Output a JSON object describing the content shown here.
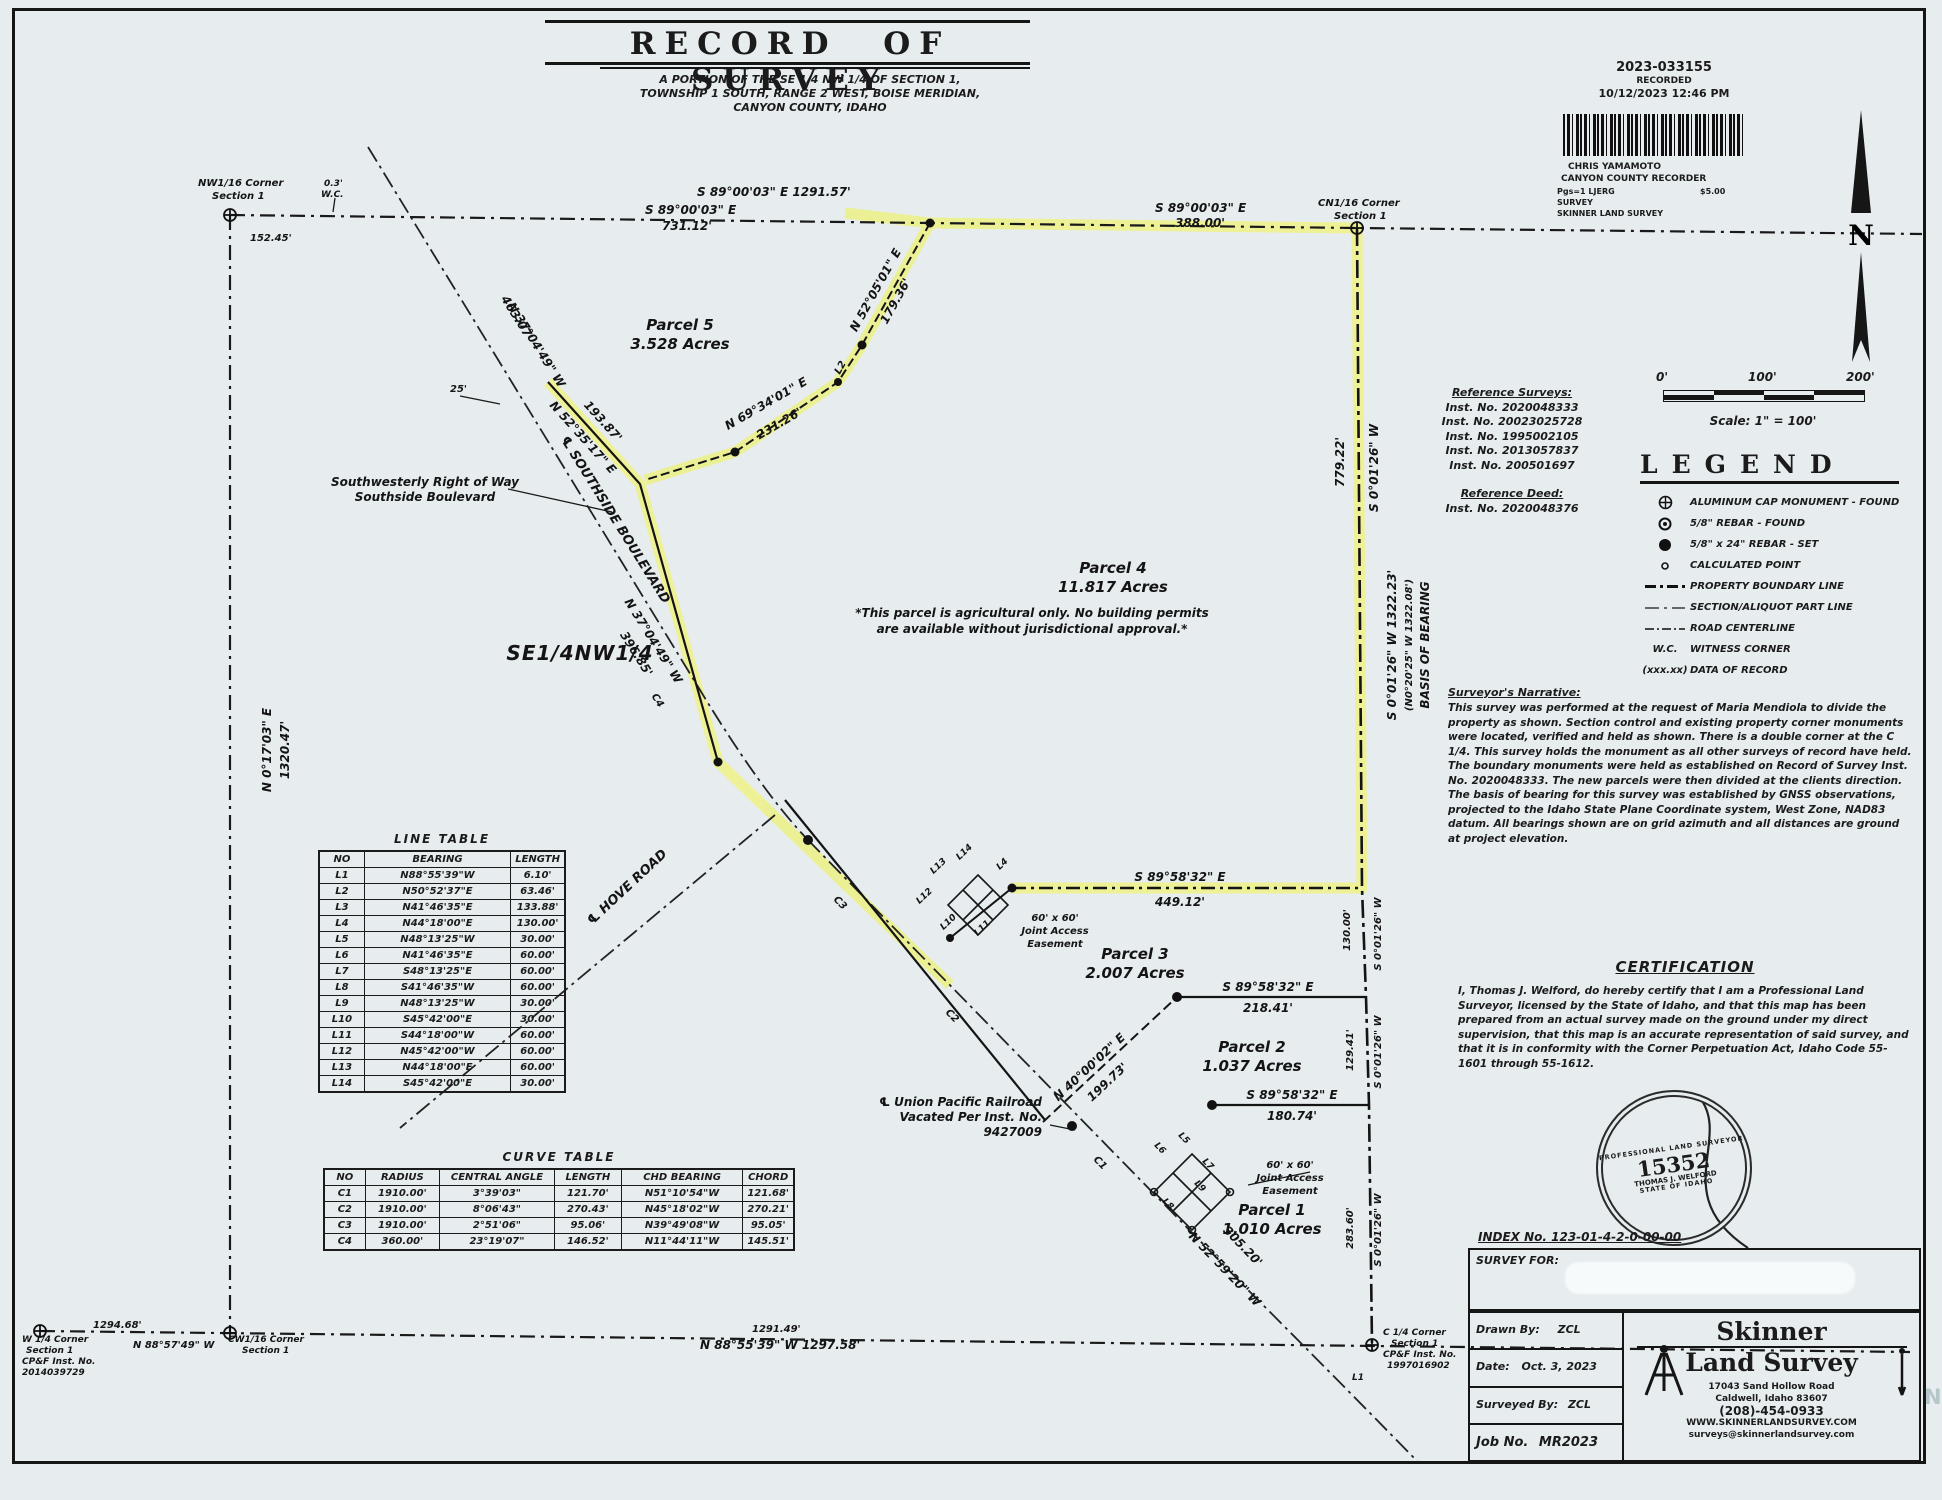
{
  "title": {
    "main": "RECORD OF SURVEY",
    "sub1": "A PORTION OF THE SE 1/4 NW 1/4 OF SECTION 1,",
    "sub2": "TOWNSHIP 1 SOUTH, RANGE 2 WEST, BOISE MERIDIAN,",
    "sub3": "CANYON COUNTY, IDAHO"
  },
  "recording": {
    "number": "2023-033155",
    "recorded": "RECORDED",
    "datetime": "10/12/2023 12:46 PM",
    "recorder_name": "CHRIS YAMAMOTO",
    "recorder_title": "CANYON COUNTY RECORDER",
    "pgs": "Pgs=1 LJERG",
    "fee": "$5.00",
    "doc_type": "SURVEY",
    "requestor": "SKINNER LAND SURVEY"
  },
  "north_label": "N",
  "scale": {
    "t0": "0'",
    "t1": "100'",
    "t2": "200'",
    "caption": "Scale: 1\" = 100'"
  },
  "legend": {
    "title": "LEGEND",
    "wc_sym": "W.C.",
    "dor_sym": "(xxx.xx)",
    "items": [
      {
        "icon": "aluminum-cap",
        "label": "ALUMINUM CAP MONUMENT - FOUND"
      },
      {
        "icon": "rebar-found",
        "label": "5/8\" REBAR - FOUND"
      },
      {
        "icon": "rebar-set",
        "label": "5/8\" x 24\" REBAR - SET"
      },
      {
        "icon": "calculated-point",
        "label": "CALCULATED POINT"
      },
      {
        "icon": "property-boundary-line",
        "label": "PROPERTY BOUNDARY LINE"
      },
      {
        "icon": "section-aliquot-line",
        "label": "SECTION/ALIQUOT PART LINE"
      },
      {
        "icon": "road-centerline",
        "label": "ROAD CENTERLINE"
      },
      {
        "icon": "witness-corner",
        "label": "WITNESS CORNER"
      },
      {
        "icon": "data-of-record",
        "label": "DATA OF RECORD"
      }
    ]
  },
  "references": {
    "surveys_title": "Reference Surveys:",
    "surveys": [
      "Inst. No. 2020048333",
      "Inst. No. 20023025728",
      "Inst. No. 1995002105",
      "Inst. No. 2013057837",
      "Inst. No. 200501697"
    ],
    "deed_title": "Reference Deed:",
    "deed": "Inst. No. 2020048376"
  },
  "narrative": {
    "title": "Surveyor's Narrative:",
    "body": "This survey was performed at the request of Maria Mendiola to divide the property as shown. Section control and existing property corner monuments were located, verified and held as shown. There is a double corner at the C 1/4. This survey holds the monument as all other surveys of record have held. The boundary monuments were held as established on Record of Survey Inst. No. 2020048333. The new parcels were then divided at the clients direction. The basis of bearing for this survey was established by GNSS observations, projected to the Idaho State Plane Coordinate system, West Zone, NAD83 datum. All bearings shown are on grid azimuth and all distances are ground at project elevation."
  },
  "certification": {
    "title": "CERTIFICATION",
    "body": "I, Thomas J. Welford, do hereby certify that I am a Professional Land Surveyor, licensed by the State of Idaho, and that this map has been prepared from an actual survey made on the ground under my direct supervision, that this map is an accurate representation of said survey, and that it is in conformity with the Corner Perpetuation Act, Idaho Code 55-1601 through 55-1612.",
    "seal_line1": "PROFESSIONAL LAND SURVEYOR",
    "seal_number": "15352",
    "seal_name": "THOMAS J. WELFORD",
    "seal_line2": "STATE OF IDAHO"
  },
  "index_label": "INDEX No. 123-01-4-2-0-00-00",
  "titleblock": {
    "survey_for_label": "SURVEY FOR:",
    "drawn_by_label": "Drawn By:",
    "drawn_by": "ZCL",
    "date_label": "Date:",
    "date": "Oct. 3, 2023",
    "surveyed_by_label": "Surveyed By:",
    "surveyed_by": "ZCL",
    "job_label": "Job No.",
    "job": "MR2023",
    "firm1": "Skinner",
    "firm2": "Land Survey",
    "addr1": "17043 Sand Hollow Road",
    "addr2": "Caldwell, Idaho 83607",
    "phone": "(208)-454-0933",
    "web": "WWW.SKINNERLANDSURVEY.COM",
    "email": "surveys@skinnerlandsurvey.com"
  },
  "watermark": "NTAIN",
  "line_table": {
    "title": "LINE TABLE",
    "headers": [
      "NO",
      "BEARING",
      "LENGTH"
    ],
    "rows": [
      [
        "L1",
        "N88°55'39\"W",
        "6.10'"
      ],
      [
        "L2",
        "N50°52'37\"E",
        "63.46'"
      ],
      [
        "L3",
        "N41°46'35\"E",
        "133.88'"
      ],
      [
        "L4",
        "N44°18'00\"E",
        "130.00'"
      ],
      [
        "L5",
        "N48°13'25\"W",
        "30.00'"
      ],
      [
        "L6",
        "N41°46'35\"E",
        "60.00'"
      ],
      [
        "L7",
        "S48°13'25\"E",
        "60.00'"
      ],
      [
        "L8",
        "S41°46'35\"W",
        "60.00'"
      ],
      [
        "L9",
        "N48°13'25\"W",
        "30.00'"
      ],
      [
        "L10",
        "S45°42'00\"E",
        "30.00'"
      ],
      [
        "L11",
        "S44°18'00\"W",
        "60.00'"
      ],
      [
        "L12",
        "N45°42'00\"W",
        "60.00'"
      ],
      [
        "L13",
        "N44°18'00\"E",
        "60.00'"
      ],
      [
        "L14",
        "S45°42'00\"E",
        "30.00'"
      ]
    ]
  },
  "curve_table": {
    "title": "CURVE TABLE",
    "headers": [
      "NO",
      "RADIUS",
      "CENTRAL ANGLE",
      "LENGTH",
      "CHD BEARING",
      "CHORD"
    ],
    "rows": [
      [
        "C1",
        "1910.00'",
        "3°39'03\"",
        "121.70'",
        "N51°10'54\"W",
        "121.68'"
      ],
      [
        "C2",
        "1910.00'",
        "8°06'43\"",
        "270.43'",
        "N45°18'02\"W",
        "270.21'"
      ],
      [
        "C3",
        "1910.00'",
        "2°51'06\"",
        "95.06'",
        "N39°49'08\"W",
        "95.05'"
      ],
      [
        "C4",
        "360.00'",
        "23°19'07\"",
        "146.52'",
        "N11°44'11\"W",
        "145.51'"
      ]
    ]
  },
  "map": {
    "nw1": "NW1/16 Corner",
    "sec1": "Section 1",
    "d152": "152.45'",
    "wc_d": "0.3'",
    "wc": "W.C.",
    "topmain": "S 89°00'03\" E    1291.57'",
    "b8900": "S 89°00'03\" E",
    "d731": "731.12'",
    "d388": "388.00'",
    "cn1": "CN1/16 Corner",
    "p5a": "Parcel 5",
    "p5b": "3.528 Acres",
    "b5205": "N 52°05'01\" E",
    "d179": "179.36'",
    "b6934": "N 69°34'01\" E",
    "d231": "231.26'",
    "b5235": "N 52°35'17\" E",
    "d193": "193.87'",
    "d25": "25'",
    "d463": "463.07'",
    "b3704": "N 37°04'49\" W",
    "d396": "396.85'",
    "row1": "Southwesterly Right of Way",
    "row2": "Southside Boulevard",
    "cl_ssb": "℄  SOUTHSIDE  BOULEVARD",
    "se14": "SE1/4NW1/4",
    "wv_b": "N 0°17'03\" E",
    "wv_d": "1320.47'",
    "p4a": "Parcel 4",
    "p4b": "11.817 Acres",
    "p4n1": "*This parcel is agricultural only. No building permits",
    "p4n2": "are available without jurisdictional approval.*",
    "d779": "779.22'",
    "s0126": "S 0°01'26\" W",
    "basis1": "S 0°01'26\" W  1322.23'",
    "basis2": "(N0°20'25\" W  1322.08')",
    "basis3": "BASIS OF BEARING",
    "b8958": "S 89°58'32\" E",
    "d449": "449.12'",
    "d218": "218.41'",
    "d180": "180.74'",
    "ease1": "60' x 60'",
    "ease2": "Joint Access",
    "ease3": "Easement",
    "p3a": "Parcel 3",
    "p3b": "2.007 Acres",
    "b4000": "N 40°00'02\" E",
    "d199": "199.73'",
    "p2a": "Parcel 2",
    "p2b": "1.037 Acres",
    "d130": "130.00'",
    "d129": "129.41'",
    "d283": "283.60'",
    "cl_hove": "℄  HOVE  ROAD",
    "rr1": "℄ Union Pacific Railroad",
    "rr2": "Vacated Per Inst. No.",
    "rr3": "9427009",
    "p1a": "Parcel 1",
    "p1b": "1.010 Acres",
    "b5259": "N 52°59'20\" W",
    "d305": "305.20'",
    "c1": "C1",
    "c2": "C2",
    "c3": "C3",
    "c4": "C4",
    "l1": "L1",
    "l2": "L2",
    "l4": "L4",
    "l5": "L5",
    "l6": "L6",
    "l7": "L7",
    "l8": "L8",
    "l9": "L9",
    "l10": "L10",
    "l11": "L11",
    "l12": "L12",
    "l13": "L13",
    "l14": "L14",
    "d1294": "1294.68'",
    "w14": "W 1/4 Corner",
    "cpf": "CP&F Inst. No.",
    "w14n": "2014039729",
    "b8857": "N 88°57'49\" W",
    "cw1": "CW1/16 Corner",
    "d1291": "1291.49'",
    "b8855": "N 88°55'39\" W   1297.58'",
    "c14": "C 1/4 Corner",
    "c14n": "1997016902"
  }
}
